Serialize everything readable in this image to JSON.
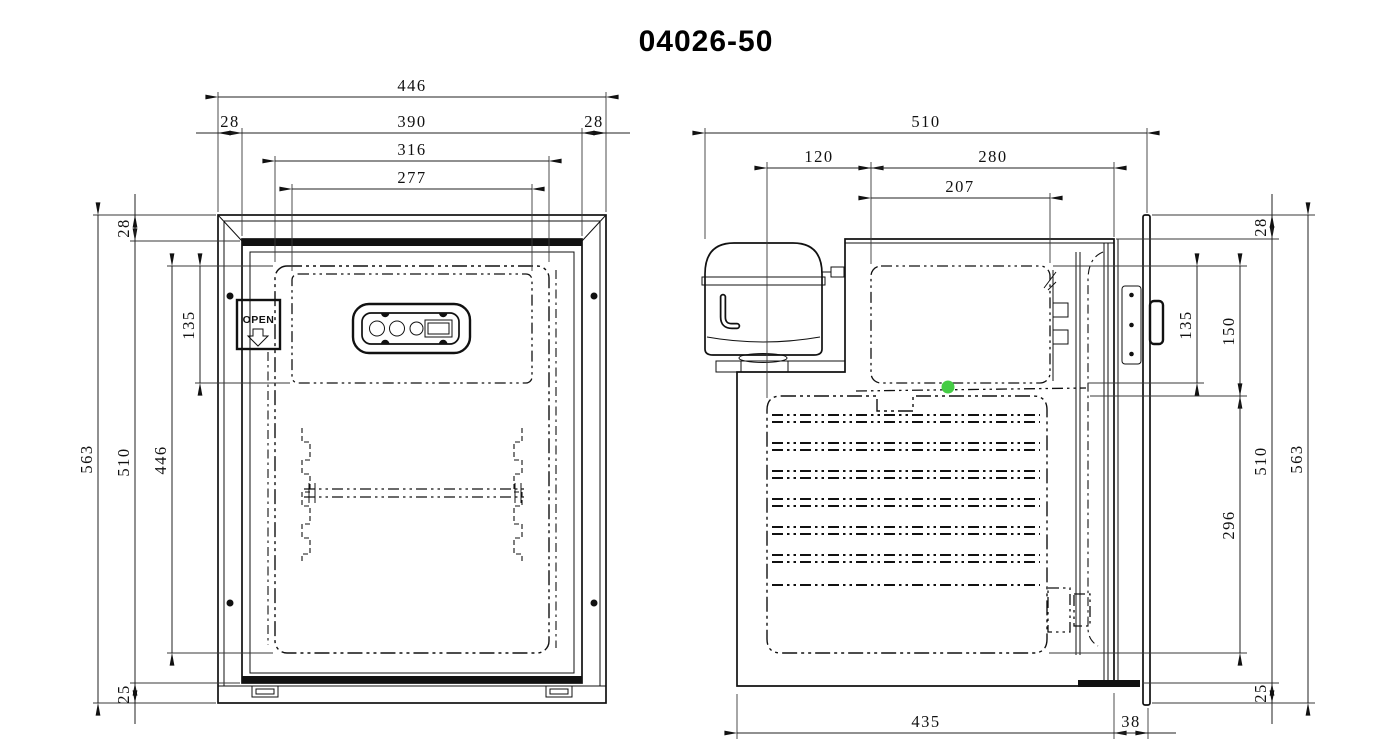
{
  "title": "04026-50",
  "colors": {
    "ink": "#111111",
    "background": "#ffffff",
    "highlight_dot": "#44cc44"
  },
  "front_view": {
    "open_label": "OPEN",
    "dims": {
      "overall_width": "446",
      "frame_left": "28",
      "door_width": "390",
      "frame_right": "28",
      "liner_width": "316",
      "freezer_width": "277",
      "overall_height": "563",
      "door_height": "510",
      "liner_height": "446",
      "freezer_height": "135",
      "top_inset": "28",
      "bottom_inset": "25"
    }
  },
  "side_view": {
    "dims": {
      "overall_depth": "510",
      "compressor_offset": "120",
      "body_depth": "280",
      "freezer_depth": "207",
      "top_inset": "28",
      "freezer_height": "135",
      "freezer_drop": "150",
      "door_height": "510",
      "coil_span": "296",
      "overall_height": "563",
      "bottom_inset": "25",
      "base_depth": "435",
      "door_thickness": "38"
    }
  }
}
